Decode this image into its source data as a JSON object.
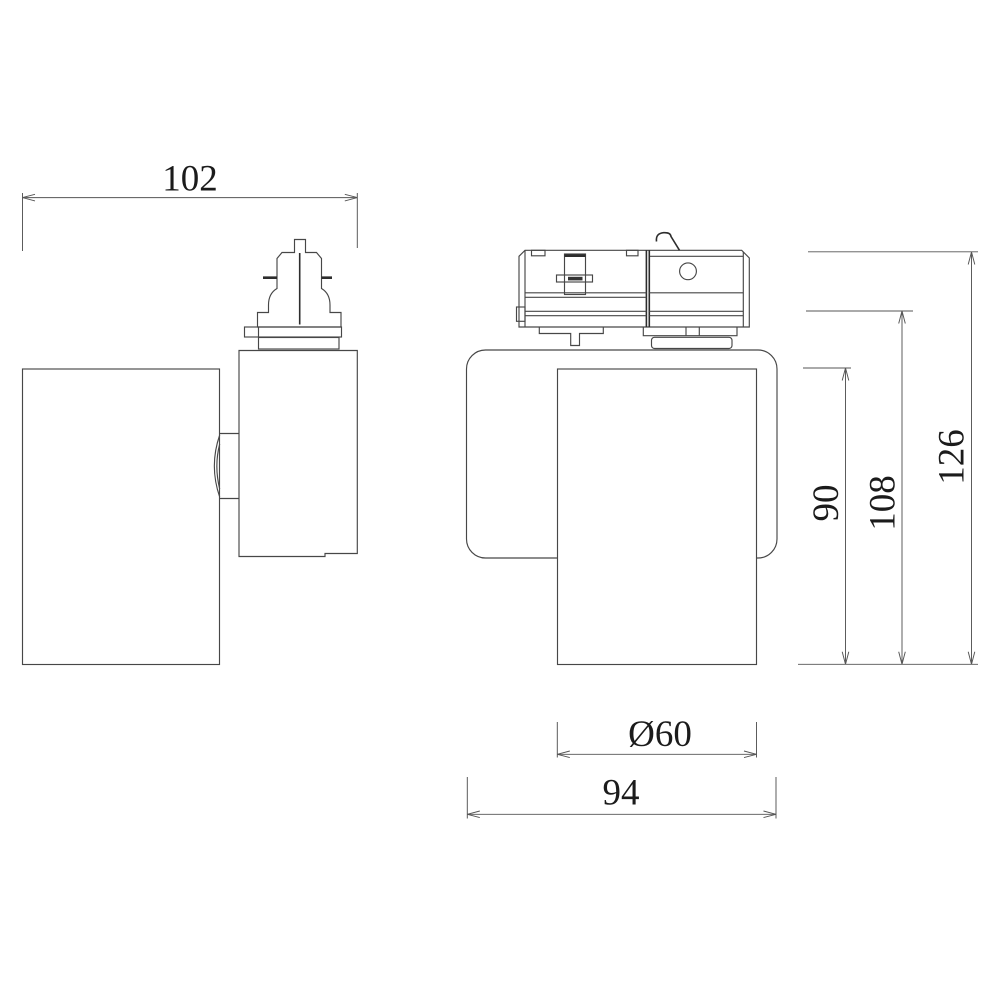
{
  "page": {
    "background": "#ffffff"
  },
  "drawing": {
    "kind": "technical-dimension-drawing",
    "subject": "track-light-spotlight-two-views",
    "line_color": "#474747",
    "dark_line_color": "#2d2d2d",
    "text_color": "#1b1b1b",
    "dimensions": {
      "top_width": "102",
      "total_height": "126",
      "height_below_track": "108",
      "lamp_body_height": "90",
      "lamp_diameter": "Ø60",
      "base_width": "94"
    }
  }
}
